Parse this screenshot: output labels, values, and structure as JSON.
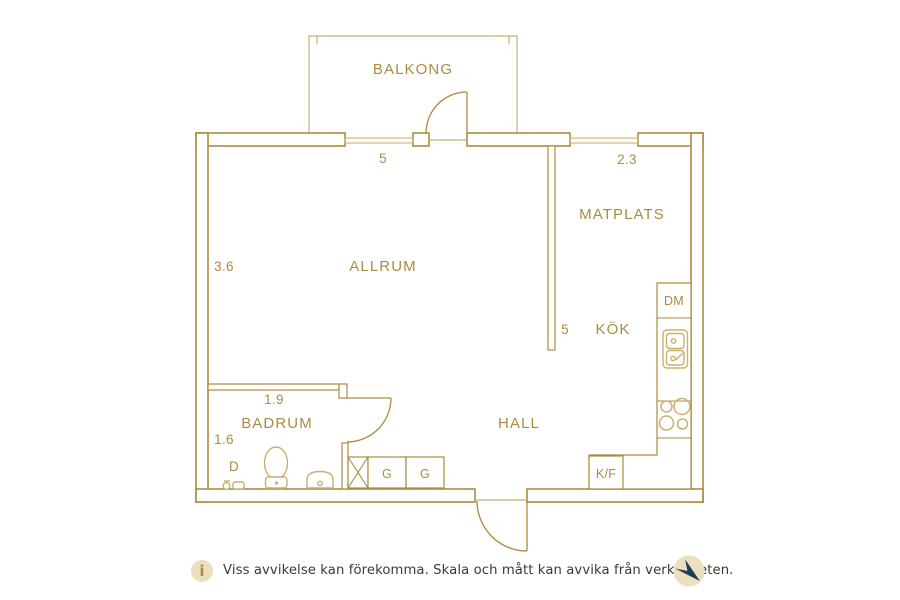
{
  "colors": {
    "gold": "#ac8b3e",
    "gold_light": "#c9b170",
    "cream": "#ecdfc0",
    "navy": "#1d3c5c",
    "text_dark": "#3c3a37"
  },
  "plan": {
    "balcony": {
      "label": "BALKONG"
    },
    "rooms": {
      "allrum": "ALLRUM",
      "matplats": "MATPLATS",
      "kok": "KÖK",
      "hall": "HALL",
      "badrum": "BADRUM"
    },
    "appliances": {
      "dishwasher": "DM",
      "fridge_freezer": "K/F",
      "wardrobe_1": "G",
      "wardrobe_2": "G",
      "shower": "D"
    },
    "measurements": {
      "window_top": "5",
      "matplats_width": "2.3",
      "allrum_height": "3.6",
      "kok_height": "5",
      "badrum_width": "1.9",
      "badrum_height": "1.6"
    }
  },
  "footer": {
    "info_symbol": "i",
    "disclaimer": "Viss avvikelse kan förekomma. Skala och mått kan avvika från verkligheten."
  }
}
